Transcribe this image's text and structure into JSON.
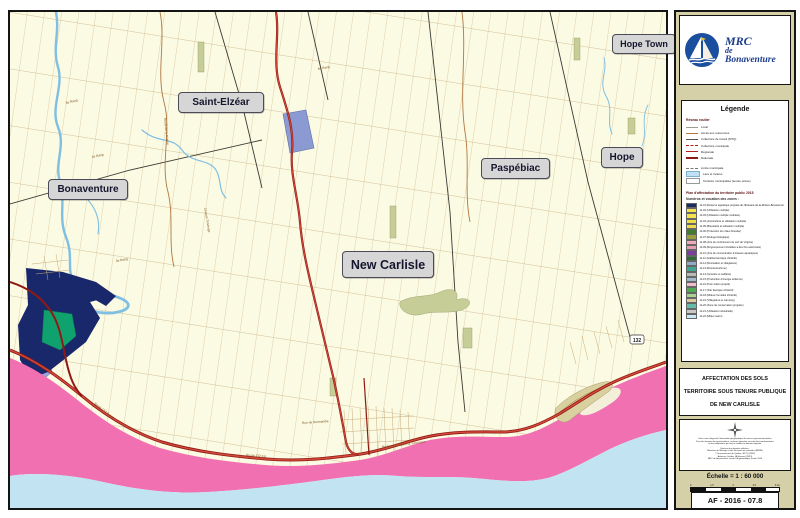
{
  "logo": {
    "line1": "MRC",
    "line2": "de",
    "line3": "Bonaventure"
  },
  "map": {
    "towns": [
      {
        "name": "Saint-Elzéar"
      },
      {
        "name": "Bonaventure"
      },
      {
        "name": "New Carlisle"
      },
      {
        "name": "Paspébiac"
      },
      {
        "name": "Hope"
      },
      {
        "name": "Hope Town"
      }
    ],
    "road_labels": [
      {
        "text": "4e Rang"
      },
      {
        "text": "5e Rang"
      },
      {
        "text": "3e Rang"
      },
      {
        "text": "6e Rang"
      },
      {
        "text": "Route de la Rivière"
      },
      {
        "text": "Chemin Thivierge"
      },
      {
        "text": "Route 132 Ouest"
      },
      {
        "text": "Route 132 Est"
      },
      {
        "text": "Boulevard Gérard-D.-Lévesque"
      },
      {
        "text": "Rue de Normandie"
      }
    ],
    "route_shield": "132",
    "colors": {
      "land": "#FBFAE3",
      "sea": "#C2E4F2",
      "coastal_zone_pink": "#F070B2",
      "navy_zone": "#18286B",
      "teal_zone": "#10A26E",
      "lavender_zone": "#9BA3D8",
      "recreation_patch": "#8B9AD2",
      "national_road": "#B5201E",
      "river": "#7FBFE4"
    }
  },
  "legend": {
    "title": "Légende",
    "roads_header": "Réseau routier",
    "road_items": [
      {
        "label": "Local"
      },
      {
        "label": "Accès aux ressources"
      },
      {
        "label": "Collectrice de transit (MTQ)"
      },
      {
        "label": "Collectrice municipale"
      },
      {
        "label": "Régionale"
      },
      {
        "label": "Nationale"
      }
    ],
    "misc_items": [
      {
        "label": "Limite municipale"
      },
      {
        "label": "Lacs et rivières"
      },
      {
        "label": "Territoire municipalisé (tenure privée)"
      }
    ],
    "patp_title": "Plan d'affectation du territoire public 2015",
    "patp_subtitle": "Numéros et vocation des zones :",
    "zones": [
      {
        "text": "11-01 (Réserve aquatique projetée de l'Estuaire-de-la-Rivière-Bonaventure)",
        "color": "#1C2B66"
      },
      {
        "text": "11-02 (Utilisation multiple)",
        "color": "#F7E14E"
      },
      {
        "text": "11-03 (Utilisation multiple modulée)",
        "color": "#F7E14E"
      },
      {
        "text": "11-04 (Acériculture et utilisation multiple)",
        "color": "#F2DC49"
      },
      {
        "text": "11-05 (Bleuetière et utilisation multiple)",
        "color": "#EFD94C"
      },
      {
        "text": "11-06 (Protection du milieu forestier)",
        "color": "#3E7C2F"
      },
      {
        "text": "11-07 (Refuge biologique)",
        "color": "#97A03A"
      },
      {
        "text": "11-08 (Aire de confinement du cerf de Virginie)",
        "color": "#F2A9BC"
      },
      {
        "text": "11-09 (Regroupement d'érables à des fins acéricoles)",
        "color": "#E79DB5"
      },
      {
        "text": "11-10 (Aire de concentration d'oiseaux aquatiques)",
        "color": "#7C3E9E"
      },
      {
        "text": "11-11 (Habitat faunique d'intérêt)",
        "color": "#2F6B36"
      },
      {
        "text": "11-12 (Récréation et villégiature)",
        "color": "#93A9C9"
      },
      {
        "text": "11-13 (Récréotourisme)",
        "color": "#41A795"
      },
      {
        "text": "11-14 (Gravière et sablière)",
        "color": "#B9B9B9"
      },
      {
        "text": "11-15 (Production d'énergie éolienne)",
        "color": "#9FB9D2"
      },
      {
        "text": "11-16 (Parc éolien projeté)",
        "color": "#F3BCCB"
      },
      {
        "text": "11-17 (Site faunique d'intérêt)",
        "color": "#4EA950"
      },
      {
        "text": "11-18 (Milieux humides d'intérêt)",
        "color": "#AAD191"
      },
      {
        "text": "11-19 (Villégiature et camping)",
        "color": "#DBCB9E"
      },
      {
        "text": "11-20 (Zone de conservation projetée)",
        "color": "#64BBA9"
      },
      {
        "text": "11-21 (Utilisation industrielle)",
        "color": "#C9C9C9"
      },
      {
        "text": "11-22 (Milieu marin)",
        "color": "#CBE9F6"
      }
    ]
  },
  "title_block": {
    "line1": "AFFECTATION DES SOLS",
    "line2": "TERRITOIRE SOUS TENURE PUBLIQUE",
    "line3": "DE NEW CARLISLE"
  },
  "disclaimer": {
    "lines": [
      "Cette carte intègre de l'information géographique de sources gouvernementales.",
      "Pour des besoins de représentation, certaines données ont subi des transformations",
      "et des adaptations qui ont pu modifier la donnée originale.",
      "Sources des données utilisées :",
      "Ministère de l'Énergie et des Ressources naturelles (MERN)",
      "© Gouvernement du Québec, BDTQ (2002)",
      "Adresses Québec (AQréseau) (2015)",
      "MRC de Bonaventure, service de géomatique, février 2016"
    ]
  },
  "scale": {
    "label": "Échelle = 1 : 60 000",
    "ticks": [
      "0",
      "1,5",
      "3",
      "4,5",
      "6 km"
    ]
  },
  "doc_code": "AF - 2016 - 07.8"
}
